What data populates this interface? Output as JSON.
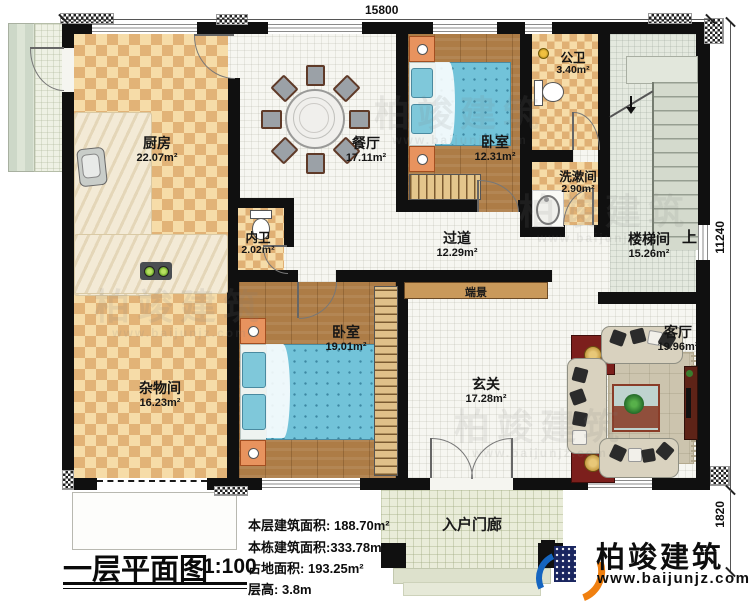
{
  "dimensions": {
    "top": "15800",
    "right": "11240",
    "porch": "1820"
  },
  "rooms": [
    {
      "name": "厨房",
      "area": "22.07m²"
    },
    {
      "name": "餐厅",
      "area": "17.11m²"
    },
    {
      "name": "卧室",
      "area": "12.31m²"
    },
    {
      "name": "公卫",
      "area": "3.40m²"
    },
    {
      "name": "洗漱间",
      "area": "2.90m²"
    },
    {
      "name": "楼梯间",
      "area": "15.26m²"
    },
    {
      "name": "过道",
      "area": "12.29m²"
    },
    {
      "name": "内卫",
      "area": "2.02m²"
    },
    {
      "name": "卧室",
      "area": "19.01m²"
    },
    {
      "name": "杂物间",
      "area": "16.23m²"
    },
    {
      "name": "玄关",
      "area": "17.28m²"
    },
    {
      "name": "客厅",
      "area": "19.96m²"
    }
  ],
  "annotations": {
    "stair_up": "上",
    "end_view": "端景",
    "porch": "入户门廊"
  },
  "title_block": {
    "title": "一层平面图",
    "scale": "1:100"
  },
  "stats": [
    {
      "label": "本层建筑面积:",
      "value": "188.70m²"
    },
    {
      "label": "本栋建筑面积:",
      "value": "333.78m²"
    },
    {
      "label": "占地面积:",
      "value": "193.25m²"
    },
    {
      "label": "层高:",
      "value": "3.8m"
    }
  ],
  "brand": {
    "name": "柏竣建筑",
    "url": "www.baijunjz.com"
  },
  "watermark": {
    "name": "柏竣建筑",
    "url": "www.baijunjz.com"
  },
  "colors": {
    "wall": "#101010",
    "checker_light": "#f6dca8",
    "checker_dark": "#e2b377",
    "wood": "#ad7c46",
    "tile": "#f6f6f1",
    "bed_blue": "#72c3d9",
    "stair": "#e4e9df",
    "porch": "#e9ecd9",
    "brand_orange": "#f08010",
    "brand_blue": "#1565c0",
    "logo_navy": "#1a2660",
    "mat_red": "#7c1f1c"
  }
}
